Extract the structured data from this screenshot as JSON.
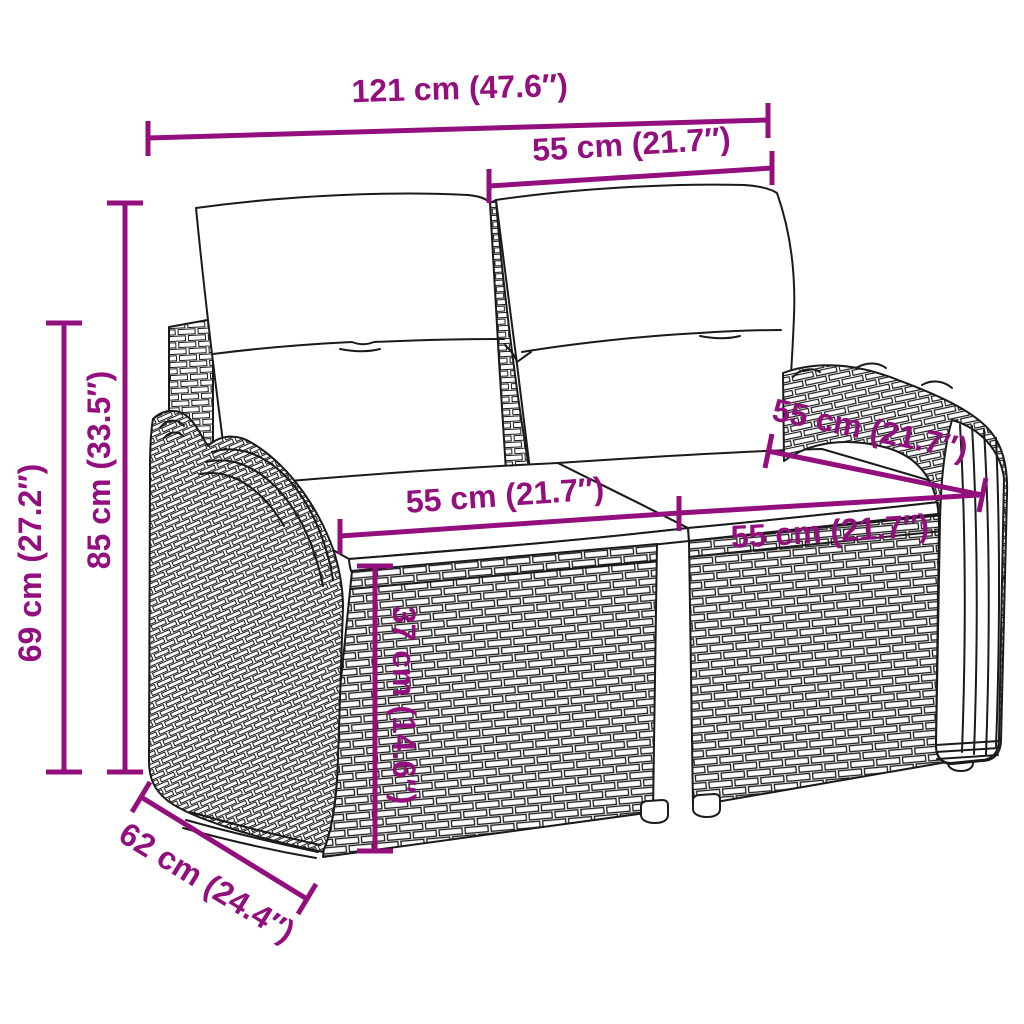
{
  "colors": {
    "accent": "#940F7E",
    "line": "#1a1a1a",
    "background": "#ffffff"
  },
  "illustration": {
    "subject_icon": "wicker-two-seater-garden-sofa-with-cushions-line-art"
  },
  "dimensions": {
    "overall_width": "121 cm (47.6″)",
    "backrest_width": "55 cm (21.7″)",
    "total_height": "85 cm (33.5″)",
    "armrest_height": "69 cm (27.2″)",
    "seat_depth": "55 cm (21.7″)",
    "seat_width_left": "55 cm (21.7″)",
    "seat_width_right": "55 cm (21.7″)",
    "seat_height": "37 cm (14.6″)",
    "overall_depth": "62 cm (24.4″)"
  }
}
